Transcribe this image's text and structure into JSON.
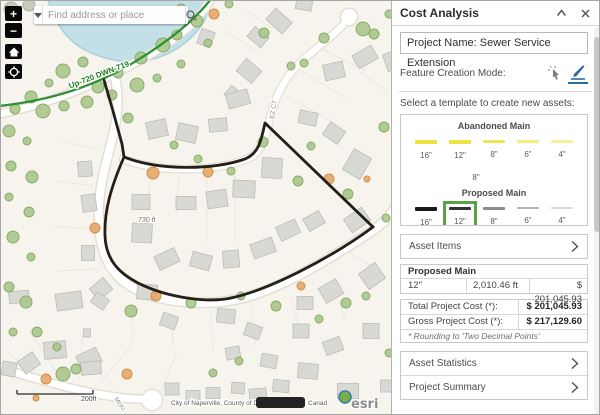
{
  "map": {
    "search": {
      "placeholder": "Find address or place"
    },
    "controls": {
      "zoom_in": "+",
      "zoom_out": "−"
    },
    "labels": {
      "pipe": "Up-720 DWN-719",
      "street_ez": "EZ CT",
      "street_mc": "McKi",
      "distance": "730 ft",
      "scale": "200ft",
      "attr_left": "City of Naperville, County of Du",
      "attr_right": "Canad",
      "esri": "esri"
    },
    "colors": {
      "bg": "#f7f4ee",
      "water": "#c3e0e8",
      "shore": "#abcfdb",
      "road_casing": "#e3dfd5",
      "road_fill": "#ffffff",
      "parcel": "#ebe7dd",
      "house_fill": "#d8d8d4",
      "house_stroke": "#bdbcb7",
      "tree_fill": "#a8c68a",
      "tree_stroke": "#8aab6b",
      "orange_fill": "#e4a768",
      "orange_stroke": "#cf8f4a",
      "muted_fill": "#c2c8b4",
      "muted_stroke": "#a9b19a",
      "green_line": "#2f8f35",
      "utility_line": "#241f17",
      "label_green": "#1e7d22",
      "street_label": "#8b8b83"
    },
    "features": {
      "water": "M 47,-2 C 52,18 62,36 82,48 C 104,60 130,64 152,58 C 175,52 195,36 204,18 C 207,11 209,4 209,-2 Z",
      "roads": [
        {
          "d": "M -2,113 C 55,102 115,75 158,48 C 182,33 200,16 210,-2",
          "cas": 10,
          "w": 7
        },
        {
          "d": "M 114,76 C 121,108 112,135 106,158 C 97,192 96,215 100,240 C 105,268 120,282 142,292 C 172,303 212,305 242,297 C 284,286 332,256 374,228 C 384,221 392,212 397,200",
          "cas": 11,
          "w": 8
        },
        {
          "d": "M 122,158 C 162,173 216,170 246,158 C 262,151 265,135 269,117 C 276,88 289,70 304,57 C 318,45 334,33 342,24",
          "cas": 9,
          "w": 6.5
        },
        {
          "d": "M -2,366 C 30,377 70,388 102,394 C 120,397 132,398 140,398",
          "cas": 10,
          "w": 7
        }
      ],
      "culdesacs": [
        {
          "x": 348,
          "y": 16,
          "r": 8
        },
        {
          "x": 151,
          "y": 399,
          "r": 10
        }
      ],
      "parcels": [
        [
          150,
          172,
          146,
          210
        ],
        [
          178,
          174,
          176,
          212
        ],
        [
          206,
          172,
          206,
          240
        ],
        [
          234,
          166,
          234,
          242
        ],
        [
          285,
          95,
          330,
          120
        ],
        [
          300,
          70,
          350,
          100
        ],
        [
          315,
          45,
          365,
          70
        ],
        [
          130,
          310,
          132,
          340
        ],
        [
          170,
          312,
          172,
          346
        ],
        [
          210,
          312,
          212,
          350
        ],
        [
          250,
          305,
          255,
          345
        ],
        [
          290,
          295,
          300,
          335
        ],
        [
          330,
          280,
          345,
          320
        ],
        [
          60,
          140,
          95,
          148
        ],
        [
          55,
          180,
          92,
          185
        ],
        [
          50,
          225,
          90,
          228
        ],
        [
          55,
          270,
          95,
          268
        ],
        [
          225,
          30,
          258,
          52
        ],
        [
          243,
          8,
          272,
          28
        ],
        [
          60,
          378,
          28,
          330
        ],
        [
          78,
          378,
          82,
          330
        ],
        [
          98,
          384,
          132,
          342
        ],
        [
          160,
          390,
          176,
          352
        ],
        [
          42,
          384,
          8,
          352
        ],
        [
          358,
          70,
          388,
          92
        ],
        [
          345,
          250,
          380,
          270
        ]
      ],
      "houses": [
        [
          303,
          4,
          16,
          10,
          10
        ],
        [
          278,
          20,
          22,
          15,
          42
        ],
        [
          257,
          36,
          18,
          13,
          40
        ],
        [
          248,
          70,
          20,
          16,
          40
        ],
        [
          233,
          94,
          16,
          12,
          40
        ],
        [
          333,
          70,
          20,
          16,
          -12
        ],
        [
          364,
          56,
          22,
          15,
          -30
        ],
        [
          205,
          37,
          14,
          16,
          20
        ],
        [
          391,
          60,
          14,
          18,
          -20
        ],
        [
          156,
          128,
          20,
          17,
          -12
        ],
        [
          186,
          132,
          20,
          17,
          12
        ],
        [
          217,
          124,
          18,
          13,
          -5
        ],
        [
          237,
          98,
          22,
          15,
          -15
        ],
        [
          307,
          117,
          18,
          13,
          12
        ],
        [
          333,
          132,
          18,
          15,
          35
        ],
        [
          356,
          163,
          20,
          24,
          30
        ],
        [
          271,
          167,
          20,
          20,
          3
        ],
        [
          243,
          188,
          22,
          17,
          3
        ],
        [
          216,
          198,
          20,
          17,
          -8
        ],
        [
          185,
          202,
          20,
          13,
          0
        ],
        [
          140,
          201,
          18,
          15,
          0
        ],
        [
          141,
          232,
          20,
          19,
          3
        ],
        [
          166,
          258,
          22,
          15,
          -25
        ],
        [
          200,
          260,
          20,
          15,
          15
        ],
        [
          230,
          258,
          16,
          17,
          -5
        ],
        [
          262,
          247,
          23,
          15,
          -20
        ],
        [
          287,
          229,
          21,
          15,
          -25
        ],
        [
          313,
          220,
          18,
          14,
          -30
        ],
        [
          356,
          219,
          22,
          16,
          -35
        ],
        [
          84,
          168,
          14,
          15,
          -5
        ],
        [
          88,
          202,
          14,
          17,
          -8
        ],
        [
          87,
          252,
          13,
          15,
          0
        ],
        [
          100,
          288,
          18,
          15,
          -40
        ],
        [
          146,
          291,
          20,
          15,
          5
        ],
        [
          304,
          302,
          16,
          13,
          0
        ],
        [
          330,
          290,
          20,
          17,
          -30
        ],
        [
          371,
          275,
          20,
          19,
          -35
        ],
        [
          18,
          296,
          20,
          12,
          -5
        ],
        [
          68,
          300,
          26,
          17,
          -8
        ],
        [
          99,
          300,
          15,
          12,
          35
        ],
        [
          54,
          349,
          22,
          17,
          -5
        ],
        [
          28,
          362,
          18,
          15,
          -35
        ],
        [
          88,
          358,
          22,
          16,
          -25
        ],
        [
          86,
          332,
          7,
          8,
          0
        ],
        [
          8,
          368,
          14,
          14,
          10
        ],
        [
          90,
          367,
          20,
          13,
          -5
        ],
        [
          171,
          388,
          14,
          12,
          0
        ],
        [
          192,
          396,
          14,
          13,
          0
        ],
        [
          212,
          392,
          14,
          11,
          0
        ],
        [
          237,
          387,
          13,
          11,
          5
        ],
        [
          257,
          394,
          17,
          13,
          -5
        ],
        [
          225,
          315,
          18,
          14,
          5
        ],
        [
          252,
          330,
          16,
          13,
          20
        ],
        [
          168,
          320,
          16,
          13,
          20
        ],
        [
          232,
          352,
          14,
          12,
          -10
        ],
        [
          268,
          360,
          16,
          13,
          10
        ],
        [
          300,
          330,
          16,
          14,
          0
        ],
        [
          332,
          345,
          18,
          14,
          -20
        ],
        [
          370,
          330,
          16,
          15,
          0
        ],
        [
          307,
          370,
          20,
          15,
          5
        ],
        [
          347,
          390,
          21,
          15,
          0
        ],
        [
          386,
          385,
          13,
          12,
          0
        ],
        [
          280,
          385,
          16,
          12,
          5
        ]
      ],
      "trees": [
        [
          62,
          70,
          7
        ],
        [
          82,
          61,
          5
        ],
        [
          97,
          86,
          6
        ],
        [
          117,
          72,
          5
        ],
        [
          140,
          57,
          6
        ],
        [
          162,
          44,
          7
        ],
        [
          180,
          63,
          4
        ],
        [
          48,
          82,
          4
        ],
        [
          30,
          96,
          6
        ],
        [
          14,
          108,
          5
        ],
        [
          42,
          110,
          7
        ],
        [
          63,
          105,
          5
        ],
        [
          86,
          101,
          6
        ],
        [
          111,
          94,
          5
        ],
        [
          136,
          84,
          7
        ],
        [
          156,
          77,
          4
        ],
        [
          176,
          34,
          5
        ],
        [
          196,
          20,
          6
        ],
        [
          207,
          42,
          4
        ],
        [
          8,
          130,
          6
        ],
        [
          26,
          140,
          4
        ],
        [
          10,
          165,
          5
        ],
        [
          31,
          176,
          6
        ],
        [
          8,
          196,
          4
        ],
        [
          28,
          211,
          5
        ],
        [
          12,
          236,
          6
        ],
        [
          30,
          256,
          4
        ],
        [
          8,
          286,
          5
        ],
        [
          25,
          301,
          6
        ],
        [
          12,
          331,
          4
        ],
        [
          36,
          331,
          5
        ],
        [
          56,
          346,
          4
        ],
        [
          127,
          117,
          5
        ],
        [
          173,
          144,
          4
        ],
        [
          197,
          158,
          4
        ],
        [
          230,
          170,
          4
        ],
        [
          262,
          141,
          5
        ],
        [
          297,
          180,
          5
        ],
        [
          347,
          193,
          5
        ],
        [
          310,
          145,
          4
        ],
        [
          130,
          310,
          6
        ],
        [
          190,
          302,
          5
        ],
        [
          240,
          295,
          4
        ],
        [
          275,
          305,
          5
        ],
        [
          345,
          302,
          5
        ],
        [
          365,
          295,
          4
        ],
        [
          318,
          318,
          4
        ],
        [
          388,
          352,
          4
        ],
        [
          62,
          373,
          7
        ],
        [
          75,
          368,
          5
        ],
        [
          263,
          32,
          5
        ],
        [
          290,
          65,
          4
        ],
        [
          323,
          37,
          5
        ],
        [
          362,
          28,
          7
        ],
        [
          373,
          33,
          5
        ],
        [
          303,
          62,
          4
        ],
        [
          228,
          3,
          4
        ],
        [
          388,
          13,
          4
        ],
        [
          180,
          8,
          5
        ],
        [
          150,
          12,
          4
        ],
        [
          383,
          126,
          5
        ],
        [
          385,
          217,
          4
        ],
        [
          212,
          372,
          4
        ],
        [
          238,
          360,
          4
        ],
        [
          10,
          8,
          7,
          "m"
        ],
        [
          28,
          4,
          6,
          "m"
        ],
        [
          44,
          12,
          5,
          "m"
        ],
        [
          152,
          172,
          6,
          "o"
        ],
        [
          207,
          171,
          5,
          "o"
        ],
        [
          328,
          178,
          5,
          "o"
        ],
        [
          155,
          295,
          5,
          "o"
        ],
        [
          300,
          285,
          4,
          "o"
        ],
        [
          45,
          378,
          5,
          "o"
        ],
        [
          35,
          397,
          3,
          "o"
        ],
        [
          213,
          13,
          5,
          "o"
        ],
        [
          366,
          178,
          3,
          "o"
        ],
        [
          94,
          227,
          5,
          "o"
        ],
        [
          126,
          373,
          5,
          "o"
        ]
      ],
      "green_line": "M -2,105 C 55,99 100,82 135,60 C 168,40 193,20 210,-2",
      "utility": [
        "M 103,79 L 112,110 L 121,143 L 123,156",
        "M 123,156 C 158,170 212,169 244,158 C 258,152 260,140 264,122 L 372,226",
        "M 123,156 C 110,186 103,210 104,235 C 105,259 118,272 137,282 C 167,297 207,302 230,297 C 268,289 330,257 372,226"
      ],
      "scalebar": {
        "x1": 16,
        "x2": 92,
        "y": 393
      }
    }
  },
  "panel": {
    "title": "Cost Analysis",
    "project_name": "Project Name: Sewer Service Extension",
    "feature_mode_label": "Feature Creation Mode:",
    "template_prompt": "Select a template to create new assets:",
    "templates": {
      "selected_color": "#57a346",
      "groups": [
        {
          "title": "Abandoned Main",
          "style": "abandoned",
          "items": [
            {
              "label": "16\"",
              "color": "#efe13c",
              "h": 3.5,
              "op": 1
            },
            {
              "label": "12\"",
              "color": "#efe13c",
              "h": 3.5,
              "op": 0.95
            },
            {
              "label": "8\"",
              "color": "#efe13c",
              "h": 3,
              "op": 0.85
            },
            {
              "label": "6\"",
              "color": "#f2e65a",
              "h": 3,
              "op": 0.8
            },
            {
              "label": "4\"",
              "color": "#f4ea74",
              "h": 2.5,
              "op": 0.75
            }
          ],
          "extra_row": [
            {
              "label": "8\"",
              "color": "#ffffff",
              "h": 3,
              "op": 1
            }
          ]
        },
        {
          "title": "Proposed Main",
          "style": "proposed",
          "selected_index": 1,
          "items": [
            {
              "label": "16\"",
              "color": "#191919",
              "h": 4,
              "op": 1
            },
            {
              "label": "12\"",
              "color": "#333333",
              "h": 3.5,
              "op": 1
            },
            {
              "label": "8\"",
              "color": "#8c8c8c",
              "h": 3,
              "op": 1
            },
            {
              "label": "6\"",
              "color": "#b4b4b4",
              "h": 2.5,
              "op": 1
            },
            {
              "label": "4\"",
              "color": "#d9d9d9",
              "h": 2,
              "op": 1
            }
          ]
        },
        {
          "title": "Proposed Valves",
          "style": "valves",
          "items": []
        }
      ]
    },
    "sections": {
      "asset_items": "Asset Items",
      "asset_statistics": "Asset Statistics",
      "project_summary": "Project Summary"
    },
    "cost_table": {
      "group_header": "Proposed Main",
      "rows": [
        [
          "12\"",
          "2,010.46 ft",
          "$ 201,045.93"
        ]
      ],
      "total_label": "Total Project Cost (*):",
      "total_value": "$ 201,045.93",
      "gross_label": "Gross Project Cost (*):",
      "gross_value": "$ 217,129.60",
      "footnote": "* Rounding to 'Two Decimal Points'"
    },
    "buttons": {
      "back": "Back",
      "refresh": "Refresh",
      "export": "Export Report"
    }
  }
}
